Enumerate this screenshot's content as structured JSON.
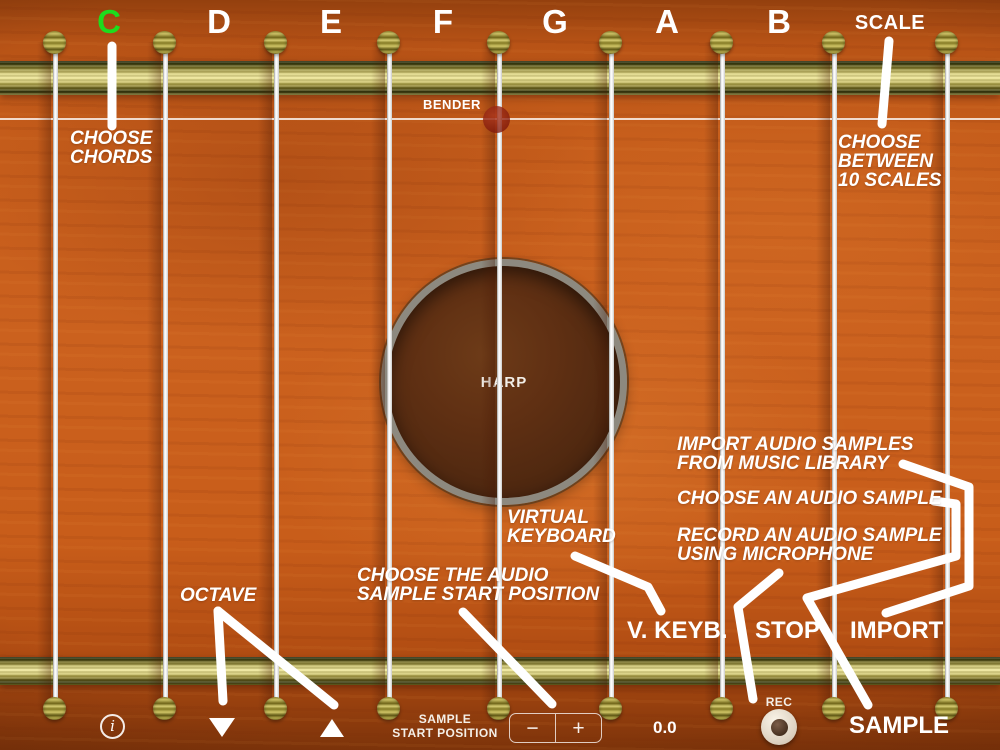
{
  "notes": {
    "items": [
      {
        "label": "C",
        "selected": true
      },
      {
        "label": "D"
      },
      {
        "label": "E"
      },
      {
        "label": "F"
      },
      {
        "label": "G"
      },
      {
        "label": "A"
      },
      {
        "label": "B"
      }
    ],
    "selected_color": "#1ddd1d",
    "scale_label": "SCALE"
  },
  "bender": {
    "label": "BENDER"
  },
  "soundhole": {
    "label": "HARP"
  },
  "annotations": {
    "choose_chords": {
      "line1": "CHOOSE",
      "line2": "CHORDS"
    },
    "choose_scales": {
      "line1": "CHOOSE",
      "line2": "BETWEEN",
      "line3": "10 SCALES"
    },
    "import_samples": {
      "line1": "IMPORT AUDIO SAMPLES",
      "line2": "FROM MUSIC LIBRARY"
    },
    "choose_sample": {
      "line1": "CHOOSE AN AUDIO SAMPLE"
    },
    "record_sample": {
      "line1": "RECORD AN AUDIO SAMPLE",
      "line2": "USING MICROPHONE"
    },
    "virtual_keyboard": {
      "line1": "VIRTUAL",
      "line2": "KEYBOARD"
    },
    "sample_start": {
      "line1": "CHOOSE THE AUDIO",
      "line2": "SAMPLE START POSITION"
    },
    "octave": {
      "line1": "OCTAVE"
    }
  },
  "buttons": {
    "v_keyb": "V. KEYB.",
    "stop": "STOP",
    "import": "IMPORT",
    "sample": "SAMPLE"
  },
  "bottom_bar": {
    "info_label": "i",
    "octave_down_icon": "triangle-down",
    "octave_up_icon": "triangle-up",
    "sample_start_line1": "SAMPLE",
    "sample_start_line2": "START POSITION",
    "stepper_minus": "−",
    "stepper_plus": "+",
    "sample_position_value": "0.0",
    "rec_label": "REC"
  }
}
